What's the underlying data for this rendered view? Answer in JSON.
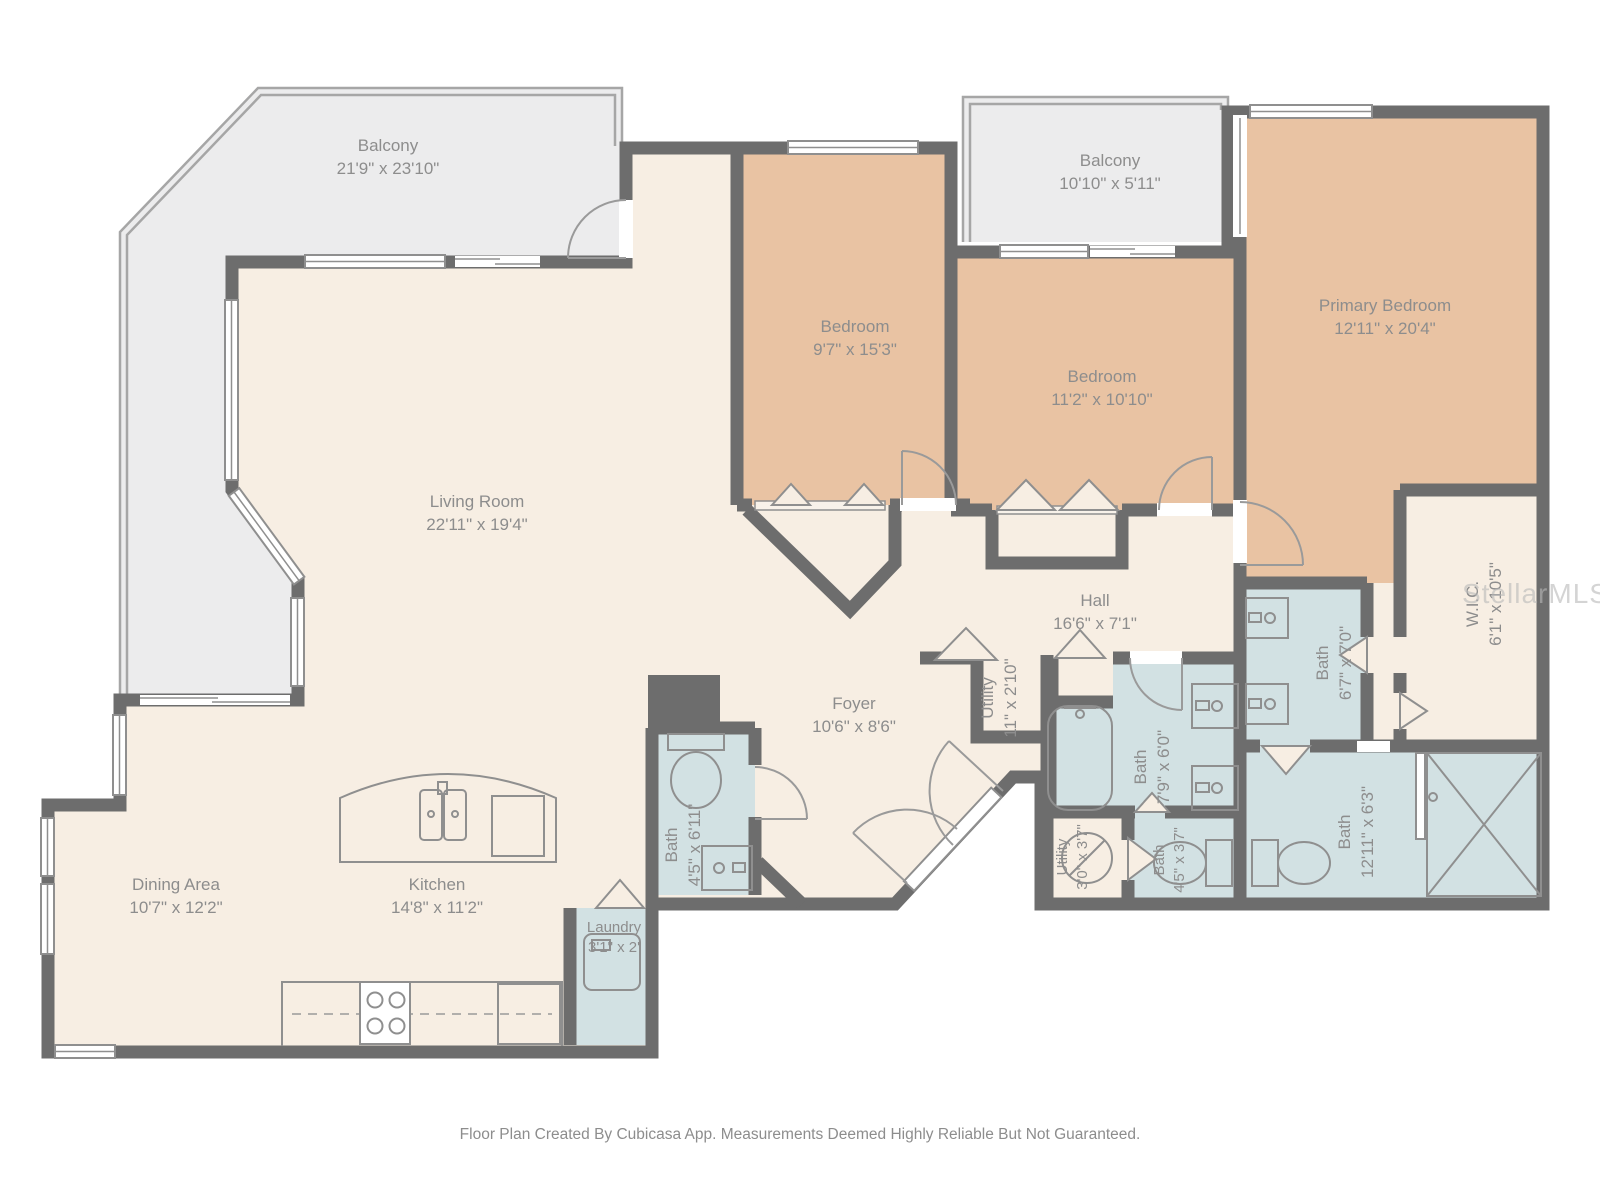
{
  "plan": {
    "footer": "Floor Plan Created By Cubicasa App. Measurements Deemed Highly Reliable But Not Guaranteed.",
    "watermark": "StellarMLS",
    "colors": {
      "floor": "#f7eee3",
      "bedroom": "#e9c3a3",
      "bath": "#d2e1e3",
      "balcony": "#ececed",
      "wall": "#6d6d6d",
      "fixture": "#8f8f8f",
      "label": "#8d8d8d"
    },
    "rooms": [
      {
        "id": "balcony-main",
        "name": "Balcony",
        "dims": "21'9\" x 23'10\""
      },
      {
        "id": "balcony-2",
        "name": "Balcony",
        "dims": "10'10\" x 5'11\""
      },
      {
        "id": "bedroom-1",
        "name": "Bedroom",
        "dims": "9'7\" x 15'3\""
      },
      {
        "id": "bedroom-2",
        "name": "Bedroom",
        "dims": "11'2\" x 10'10\""
      },
      {
        "id": "primary-bedroom",
        "name": "Primary Bedroom",
        "dims": "12'11\" x 20'4\""
      },
      {
        "id": "living-room",
        "name": "Living Room",
        "dims": "22'11\" x 19'4\""
      },
      {
        "id": "hall",
        "name": "Hall",
        "dims": "16'6\" x 7'1\""
      },
      {
        "id": "foyer",
        "name": "Foyer",
        "dims": "10'6\" x 8'6\""
      },
      {
        "id": "wic",
        "name": "W.I.C.",
        "dims": "6'1\" x 10'5\""
      },
      {
        "id": "bath-primary",
        "name": "Bath",
        "dims": "6'7\" x 7'0\""
      },
      {
        "id": "bath-hall",
        "name": "Bath",
        "dims": "7'9\" x 6'0\""
      },
      {
        "id": "utility-hall",
        "name": "Utility",
        "dims": "11\" x 2'10\""
      },
      {
        "id": "bath-foyer",
        "name": "Bath",
        "dims": "4'5\" x 6'11\""
      },
      {
        "id": "utility-small",
        "name": "Utility",
        "dims": "3'0\" x 3'7\""
      },
      {
        "id": "bath-small",
        "name": "Bath",
        "dims": "4'5\" x 3'7\""
      },
      {
        "id": "bath-large",
        "name": "Bath",
        "dims": "12'11\" x 6'3\""
      },
      {
        "id": "dining-area",
        "name": "Dining Area",
        "dims": "10'7\" x 12'2\""
      },
      {
        "id": "kitchen",
        "name": "Kitchen",
        "dims": "14'8\" x 11'2\""
      },
      {
        "id": "laundry",
        "name": "Laundry",
        "dims": "3'1\" x 2'"
      }
    ]
  }
}
